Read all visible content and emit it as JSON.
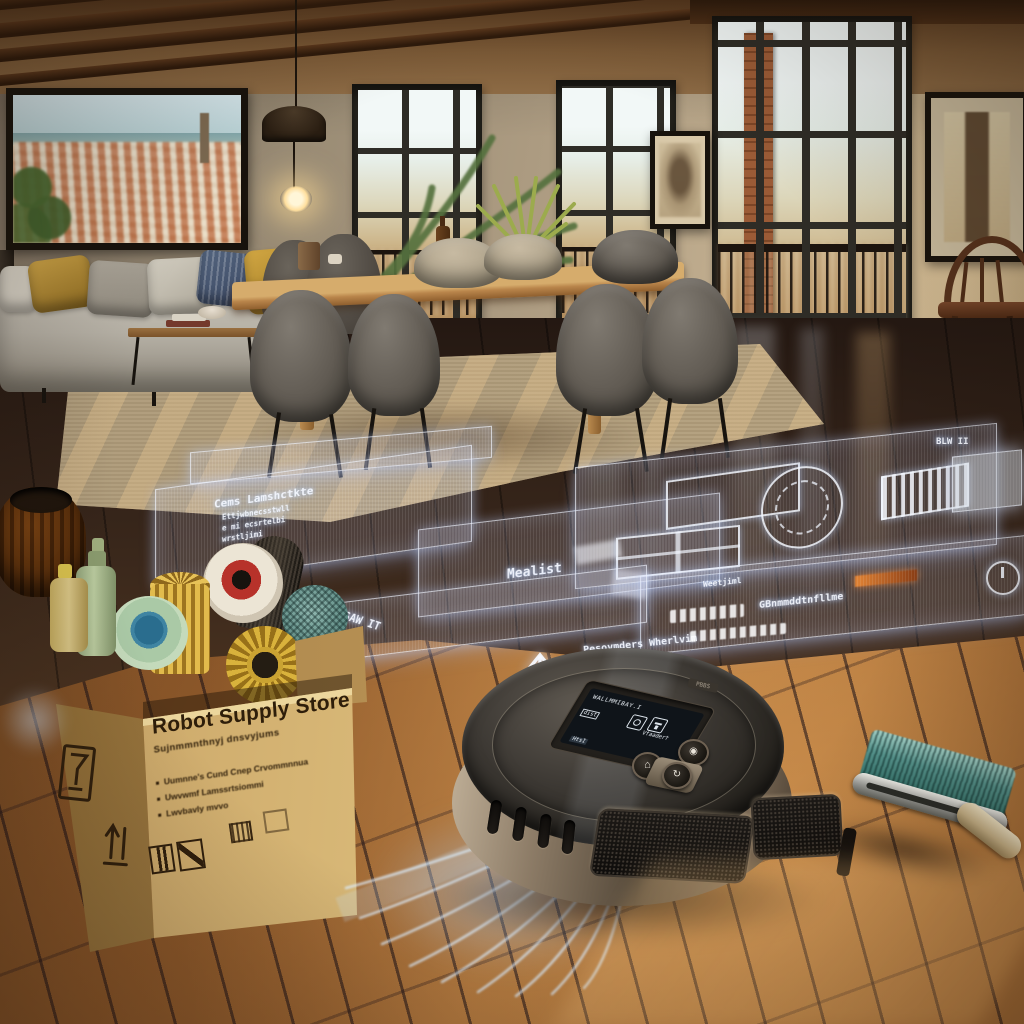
{
  "palette": {
    "wall": "#a3947d",
    "wall_light": "#cbb795",
    "beam": "#4a2d16",
    "floor_dark": "#2f2018",
    "floor_wood": "#a0662f",
    "rug": "#b2a080",
    "holo_fill": "rgba(198,208,235,0.16)",
    "holo_edge": "rgba(238,244,255,0.7)",
    "cardboard": "#c8a76b",
    "cardboard_side": "#a07c49",
    "print_ink": "#2e1e0a",
    "robot_body": "#27241f",
    "robot_rim": "#9b8b76",
    "glow_blue": "#cfe9ff",
    "brush_teal": "#3e7d76",
    "sun_accent": "#c96a2e"
  },
  "box": {
    "title": "Robot Supply Store",
    "subtitle": "Sujnmmnthnyj dnsvyjums",
    "bullets": [
      "Uumnne's Cund Cnep Crvommnnua",
      "Uwvwmf Lamssrtsiommi",
      "Lwvbavly mvvo"
    ]
  },
  "hologram": {
    "panel_a_title": "Cems Lamshctkte",
    "panel_a_lines": [
      "Ettjwbnecsstwll",
      "e mi ecsrtelbi",
      "wrstljimi"
    ],
    "label_mealist": "Mealist",
    "label_saw": "SAW IT",
    "arrow_caption": "Pesovmders Wherlvim",
    "arrow_caption2": "Iolmsguls",
    "right_list": "GBnmmddtnfllme",
    "right_small": "Weetjiml",
    "top_tag": "BLW II"
  },
  "robot": {
    "deck_label": "PBBS",
    "screen_title": "WALLMMIBAY.I",
    "screen_sub": "Vfaaderf",
    "screen_tag": "dist",
    "screen_bottom": "HtsI",
    "button_home": "home",
    "button_power": "power",
    "button_spot": "spot"
  }
}
